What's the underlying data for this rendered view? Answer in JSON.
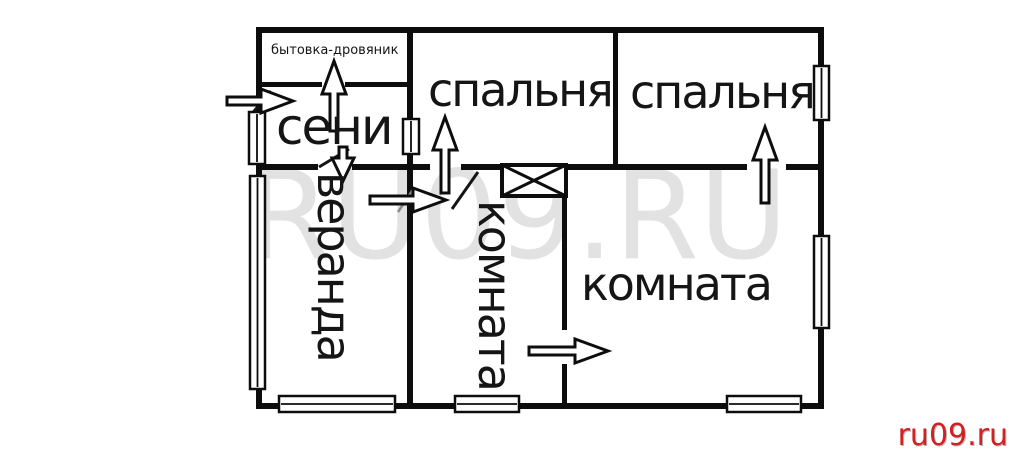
{
  "floor_plan": {
    "title": "house floor plan",
    "wall_color": "#0d0d0d",
    "rooms": [
      {
        "name": "utility-room",
        "label": "бытовка-дровяник"
      },
      {
        "name": "entry-hall",
        "label": "сени"
      },
      {
        "name": "bedroom-1",
        "label": "спальня"
      },
      {
        "name": "bedroom-2",
        "label": "спальня"
      },
      {
        "name": "veranda",
        "label": "веранда"
      },
      {
        "name": "inner-room",
        "label": "комната"
      },
      {
        "name": "main-room",
        "label": "комната"
      }
    ],
    "icons": {
      "stove": "stove-crossed-box-icon",
      "door_arrows": [
        "entry-door-arrow-icon",
        "utility-door-arrow-icon",
        "veranda-door-arrow-icon",
        "bedroom-1-door-arrow-icon",
        "bedroom-2-door-arrow-icon",
        "inner-room-door-arrow-icon",
        "main-room-door-arrow-icon"
      ],
      "windows_count": 8
    }
  },
  "watermark": {
    "center_text": "RU09.RU",
    "center_color": "#e2e2e2"
  },
  "site_credit": {
    "text": "ru09.ru",
    "color": "#d32121"
  }
}
